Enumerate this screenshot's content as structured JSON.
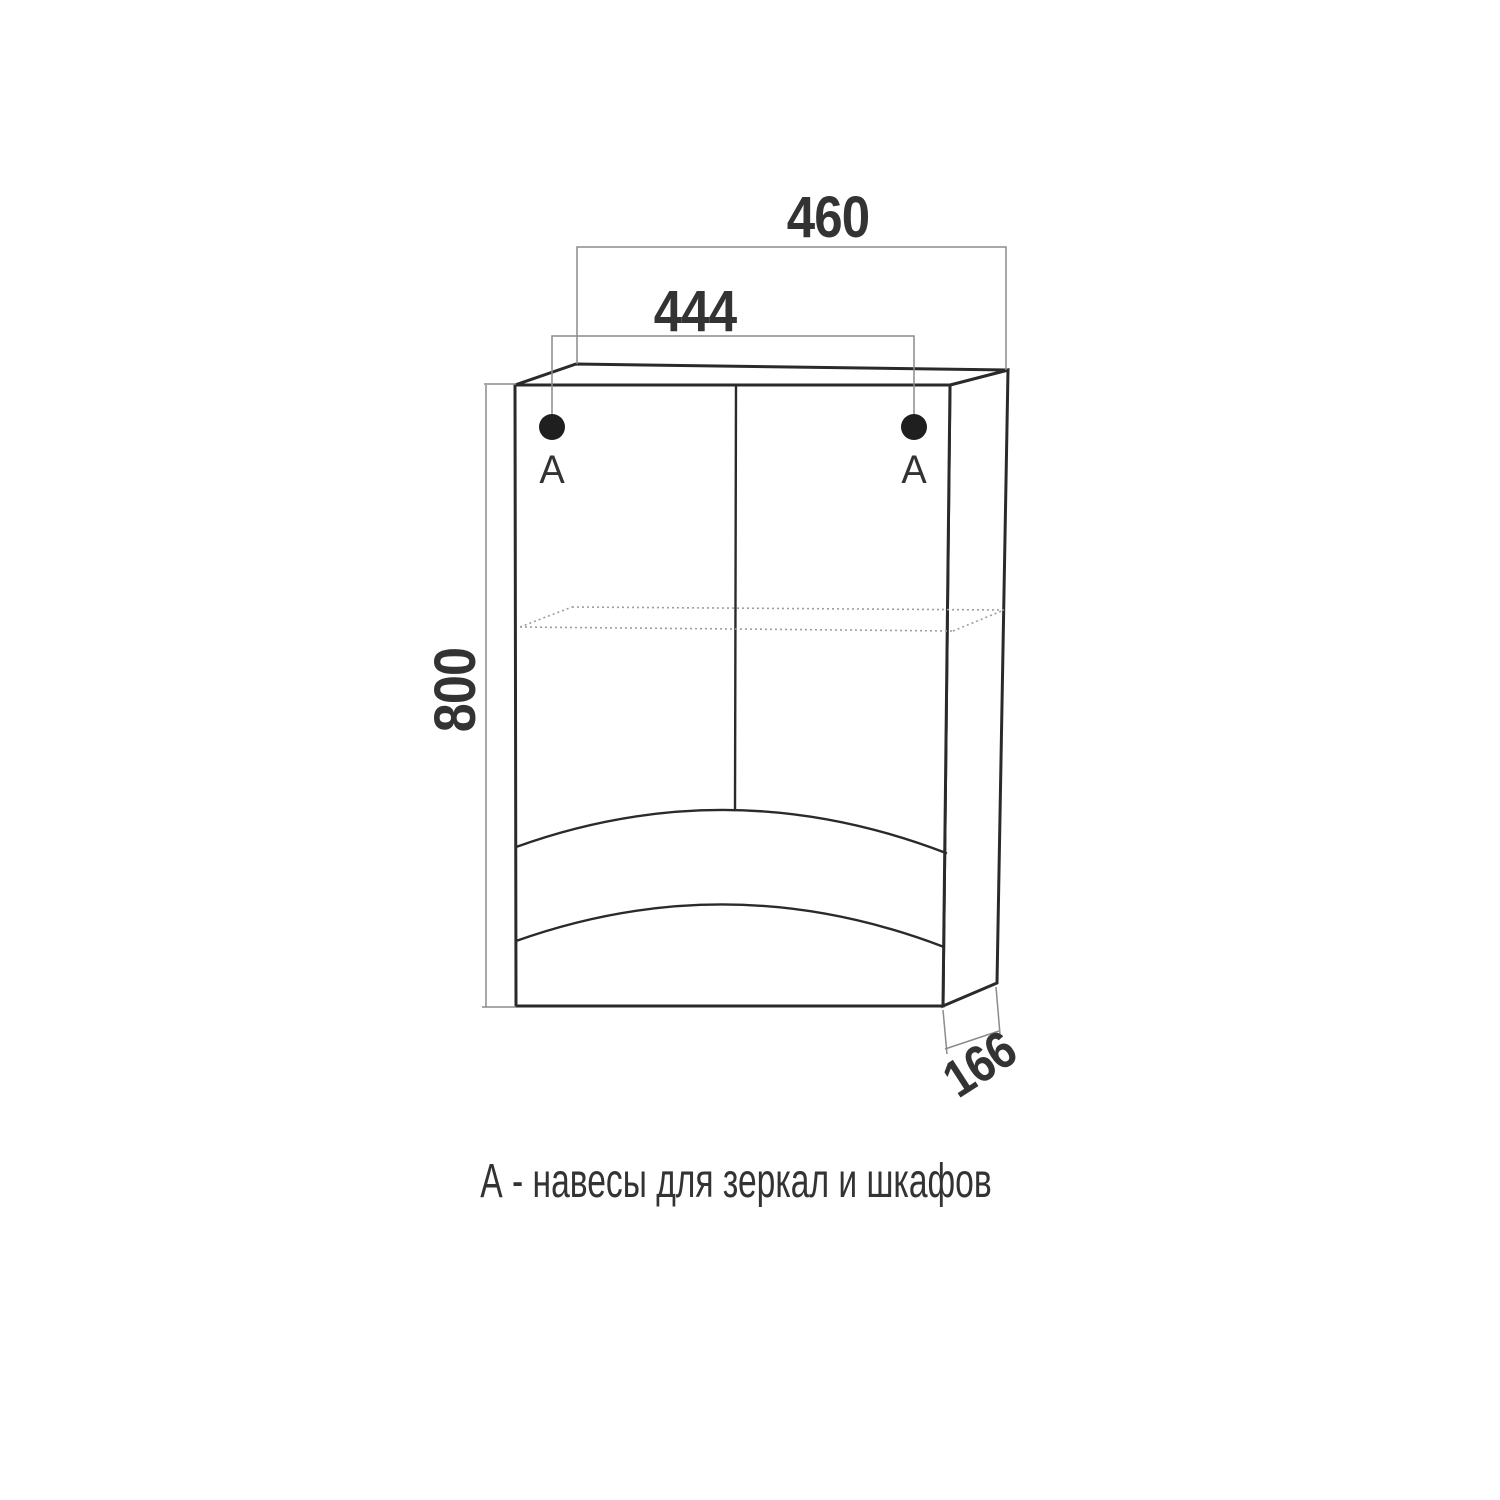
{
  "diagram": {
    "type": "furniture-dimension-drawing",
    "caption": "А - навесы для зеркал и шкафов",
    "dimensions": {
      "overall_width_mm": "460",
      "hanger_spacing_mm": "444",
      "height_mm": "800",
      "depth_mm": "166"
    },
    "markers": {
      "left": "А",
      "right": "А"
    },
    "colors": {
      "outline": "#2a2a2a",
      "dimension": "#8c8c8c",
      "shelf": "#9e9e9e",
      "text": "#333333",
      "dot": "#1f1f1f",
      "background": "#ffffff"
    }
  }
}
